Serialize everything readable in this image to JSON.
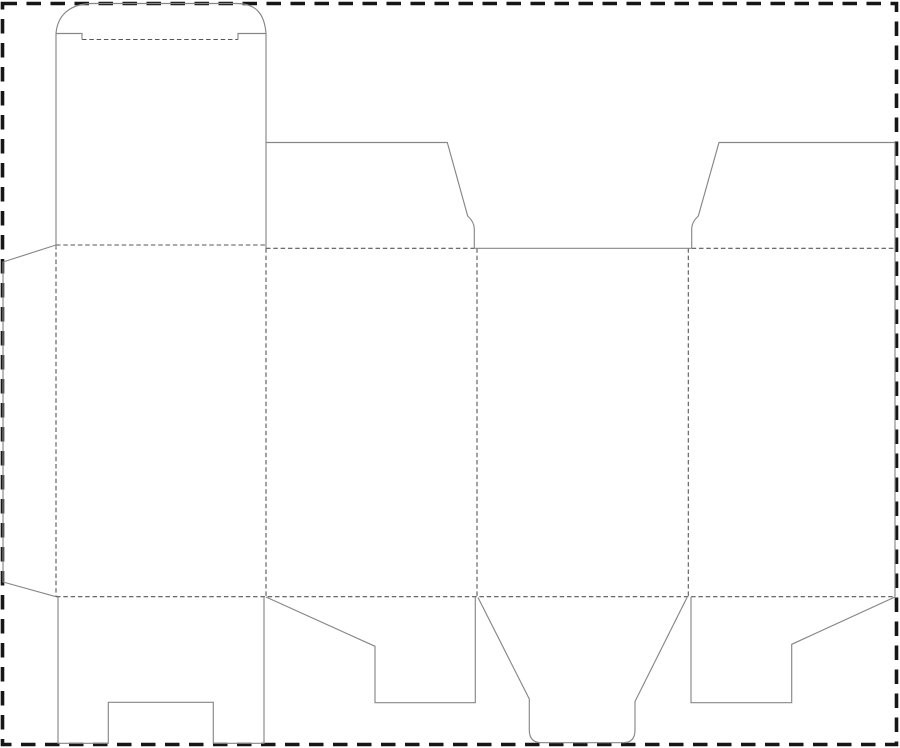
{
  "canvas": {
    "width": 900,
    "height": 748,
    "background": "#ffffff"
  },
  "page_border": {
    "x": 2.5,
    "y": 3.5,
    "width": 894,
    "height": 741,
    "color": "#161616",
    "stroke_width": 3.6,
    "dash": "14.5 9.5"
  },
  "styles": {
    "cut": {
      "color": "#878787",
      "stroke_width": 1.15,
      "dash": ""
    },
    "fold": {
      "color": "#575757",
      "stroke_width": 1.1,
      "dash": "4.5 2.8"
    }
  },
  "cut_lines": [
    {
      "name": "tuck-lid-outline",
      "d": "M 56 248 L 56 33.5 C 57.5 15 70 3.5 93 3.5 L 237 3.5 C 257 3.5 264.5 15 266 33.5 L 266 248.3"
    },
    {
      "name": "tuck-shoulder-left",
      "d": "M 56 33.5 L 82 33.5 L 82 39.5"
    },
    {
      "name": "tuck-shoulder-right",
      "d": "M 238 39.5 L 238 33.5 L 266 33.5"
    },
    {
      "name": "top-dust-flap-left",
      "d": "M 266 142.5 L 447.3 142.5 L 467.7 216 Q 474.3 222 474.3 229 L 474.3 248.3"
    },
    {
      "name": "panel-3-top-opening-edge",
      "d": "M 474.3 248.3 L 691.7 248.3"
    },
    {
      "name": "top-dust-flap-right",
      "d": "M 691.7 248.3 L 691.7 229 Q 691.7 222 698.3 216 L 719 142.5 L 895 142.5"
    },
    {
      "name": "right-side-edge",
      "d": "M 895 142.5 L 895 596.7"
    },
    {
      "name": "glue-flap-outline",
      "d": "M 56 245 L 3 262 L 3 582 L 56 596.7"
    },
    {
      "name": "bottom-flap-panel-1-notched",
      "d": "M 58 597 L 58 743.3 L 108.3 743.3 L 108.3 702.3 L 213.3 702.3 L 213.3 743.3 L 264 743.3 L 264 597"
    },
    {
      "name": "bottom-dust-flap-panel-2",
      "d": "M 266 597 L 375 646.3 L 375 702.7 L 475.3 702.7 L 475.3 597"
    },
    {
      "name": "bottom-tuck-flap-panel-3",
      "d": "M 478 597.5 L 529.3 699 L 529.3 730 Q 529.3 742.7 541.5 742.7 L 623 742.7 Q 635 742.7 635 730 L 635 701.5 L 687 597.5"
    },
    {
      "name": "bottom-dust-flap-panel-4",
      "d": "M 691 597 L 691 702.7 L 791.7 702.7 L 791.7 644.3 L 895 597"
    }
  ],
  "fold_lines": [
    {
      "name": "tuck-lid-crease",
      "d": "M 82 39.5 L 238 39.5"
    },
    {
      "name": "top-crease-panel-1",
      "d": "M 56 245 L 266 245"
    },
    {
      "name": "top-crease-panel-2",
      "d": "M 266 248.3 L 474.3 248.3"
    },
    {
      "name": "top-crease-panel-4",
      "d": "M 691.7 248.3 L 895 248.3"
    },
    {
      "name": "bottom-crease-full-width",
      "d": "M 56 596.7 L 895 596.7"
    },
    {
      "name": "vertical-crease-glue-flap",
      "d": "M 56 245 L 56 596.7"
    },
    {
      "name": "vertical-crease-panel-1-2",
      "d": "M 266 248.3 L 266 596.7"
    },
    {
      "name": "vertical-crease-panel-2-3",
      "d": "M 477 248.3 L 477 596.7"
    },
    {
      "name": "vertical-crease-panel-3-4",
      "d": "M 688.3 248.3 L 688.3 596.7"
    }
  ]
}
